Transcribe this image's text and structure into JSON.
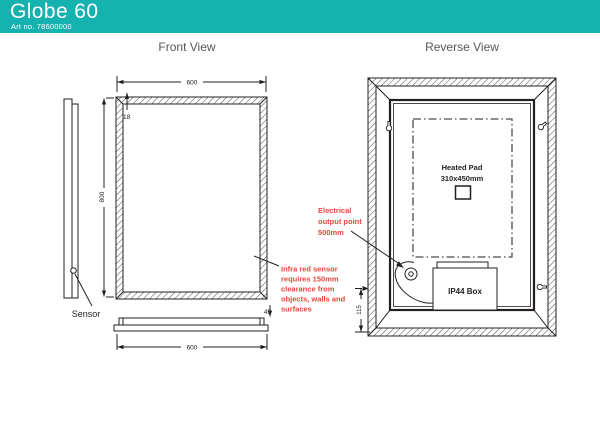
{
  "header": {
    "title": "Globe 60",
    "art_no": "Art no. 78600000"
  },
  "view_labels": {
    "front": "Front View",
    "reverse": "Reverse View"
  },
  "front_view": {
    "dim_top_width": "600",
    "dim_frame_thickness": "18",
    "dim_height": "800",
    "dim_bottom_width": "600",
    "dim_depth": "45",
    "sensor_label": "Sensor",
    "sensor_note_line1": "Infra red sensor",
    "sensor_note_line2": "requires 150mm",
    "sensor_note_line3": "clearance from",
    "sensor_note_line4": "objects, walls and",
    "sensor_note_line5": "surfaces"
  },
  "reverse_view": {
    "heated_pad_line1": "Heated Pad",
    "heated_pad_line2": "310x450mm",
    "ip44_label": "IP44 Box",
    "dim_output_height": "115",
    "electrical_note_line1": "Electrical",
    "electrical_note_line2": "output point",
    "electrical_note_line3": "500mm"
  },
  "colors": {
    "header_bg": "#16b2af",
    "line": "#231f20",
    "note_red": "#e8453c",
    "label_gray": "#55565a"
  }
}
